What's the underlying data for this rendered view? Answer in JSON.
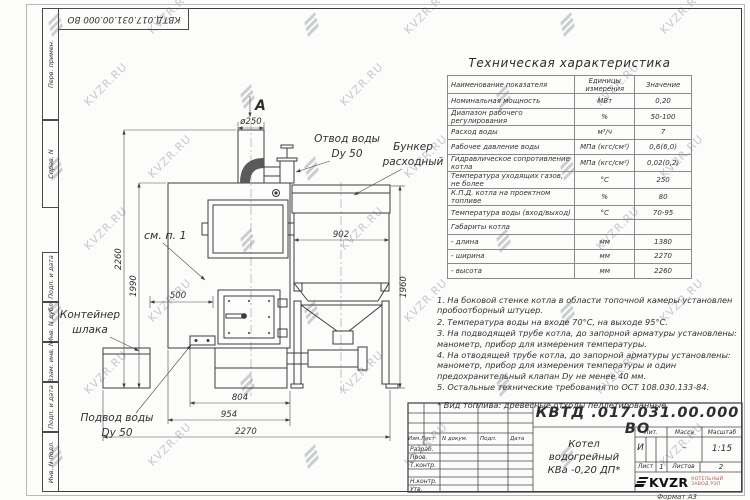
{
  "sheet": {
    "doc_number": "КВТД .017.031.00.000  ВО",
    "doc_number_top": "КВТД.017.031.00.000  ВО",
    "format_note": "Формат А3",
    "watermark_text": "KVZR.RU"
  },
  "strip": {
    "labels": [
      "Перв. примен.",
      "Справ. N",
      "Подп. и дата",
      "Инв. N дубл.",
      "Взам. инв. N",
      "Подп. и дата",
      "Инв. N подл."
    ]
  },
  "spec_table": {
    "title": "Техническая характеристика",
    "col_name": "Наименование показателя",
    "col_units": "Единицы измерения",
    "col_value": "Значение",
    "rows": [
      {
        "n": "Номинальная мощность",
        "u": "МВт",
        "v": "0,20"
      },
      {
        "n": "Диапазон рабочего регулирования",
        "u": "%",
        "v": "50-100"
      },
      {
        "n": "Расход воды",
        "u": "м³/ч",
        "v": "7"
      },
      {
        "n": "Рабочее давление воды",
        "u": "МПа (кгс/см²)",
        "v": "0,6(6,0)"
      },
      {
        "n": "Гидравлическое сопротивление котла",
        "u": "МПа (кгс/см²)",
        "v": "0,02(0,2)"
      },
      {
        "n": "Температура уходящих газов, не более",
        "u": "°С",
        "v": "250"
      },
      {
        "n": "К.П.Д. котла на проектном топливе",
        "u": "%",
        "v": "80"
      },
      {
        "n": "Температура воды (вход/выход)",
        "u": "°С",
        "v": "70-95"
      },
      {
        "n": "Габариты котла",
        "u": "",
        "v": ""
      },
      {
        "n": "- длина",
        "u": "мм",
        "v": "1380"
      },
      {
        "n": "- ширина",
        "u": "мм",
        "v": "2270"
      },
      {
        "n": "- высота",
        "u": "мм",
        "v": "2260"
      }
    ]
  },
  "notes": {
    "items": [
      "1.  На боковой стенке котла в области топочной камеры установлен пробоотборный штуцер.",
      "2.  Температура воды на входе 70°С, на выходе 95°С.",
      "3.  На подводящей трубе котла, до запорной арматуры установлены: манометр, прибор для измерения температуры.",
      "4.  На отводящей трубе котла, до запорной арматуры установлены: манометр, прибор для измерения температуры и один предохранительный клапан Dy не менее 40 мм.",
      "5.  Остальные технические требования по ОСТ 108.030.133-84.",
      "*  Вид топлива: древесные отходы пеллетированные."
    ]
  },
  "drawing": {
    "labels": {
      "view": "А",
      "outlet1": "Отвод воды",
      "outlet2": "Dy 50",
      "bunker1": "Бункер",
      "bunker2": "расходный",
      "see_note": "см. п. 1",
      "container1": "Контейнер",
      "container2": "шлака",
      "inlet1": "Подвод воды",
      "inlet2": "Dy 50"
    },
    "dims": {
      "chimney": "ø250",
      "bunker_w": "902",
      "total_h": "2260",
      "boiler_h": "1990",
      "bunker_h": "1960",
      "offset": "500",
      "base_w": "804",
      "body_w": "954",
      "total_w": "2270"
    }
  },
  "title_block": {
    "hdr_izm": "Изм.Лист",
    "hdr_doc": "N докум.",
    "hdr_sign": "Подп.",
    "hdr_date": "Дата",
    "roles": [
      "Разраб.",
      "Пров.",
      "Т.контр.",
      "Н.контр.",
      "Утв."
    ],
    "product1": "Котел водогрейный",
    "product2": "КВа -0,20  ДП*",
    "lit_h": "Лит.",
    "mass_h": "Масса",
    "scale_h": "Масштаб",
    "lit_v": "И",
    "mass_v": "–",
    "scale_v": "1:15",
    "sheet_h": "Лист",
    "sheet_v": "1",
    "sheets_h": "Листов",
    "sheets_v": "2",
    "logo": "KVZR",
    "logo_sub1": "КОТЕЛЬНЫЙ",
    "logo_sub2": "ЗАВОД РЭП"
  }
}
